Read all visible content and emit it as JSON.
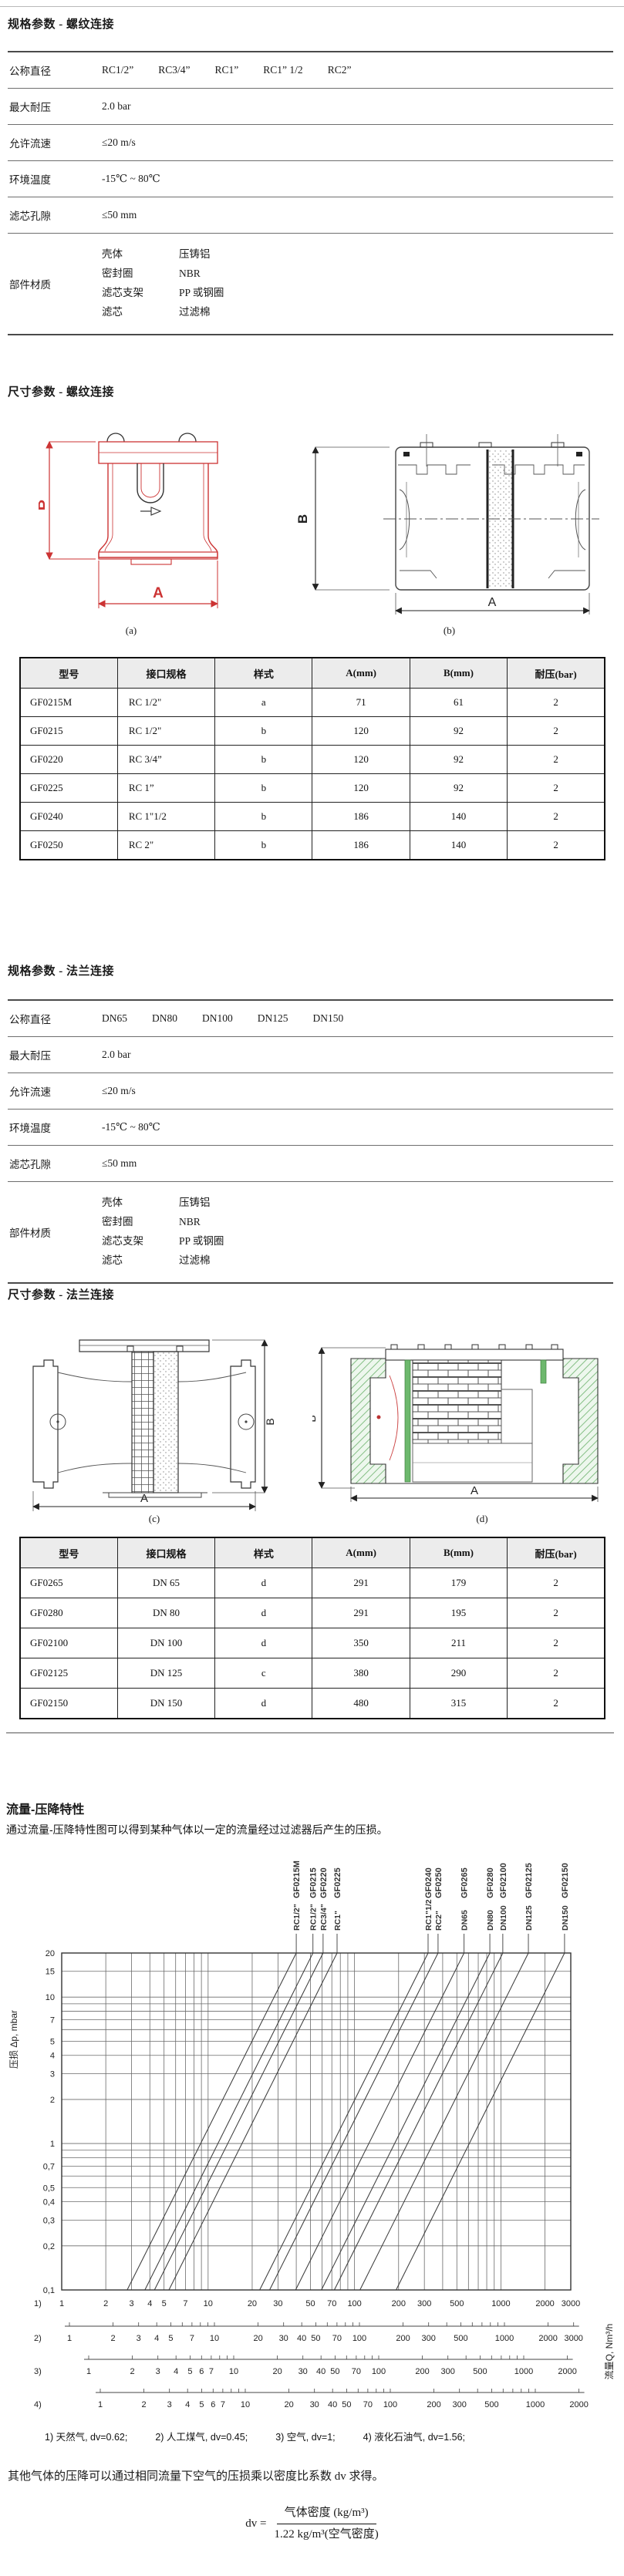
{
  "figures": {
    "dim_a": "A",
    "dim_b": "B"
  },
  "spec_thread": {
    "heading": "规格参数 - 螺纹连接",
    "rows": [
      {
        "label": "公称直径",
        "values": [
          "RC1/2”",
          "RC3/4”",
          "RC1”",
          "RC1” 1/2",
          "RC2”"
        ]
      },
      {
        "label": "最大耐压",
        "value": "2.0 bar"
      },
      {
        "label": "允许流速",
        "value": "≤20 m/s"
      },
      {
        "label": "环境温度",
        "value": "-15℃ ~ 80℃"
      },
      {
        "label": "滤芯孔隙",
        "value": "≤50 mm"
      },
      {
        "label": "部件材质",
        "pairs": [
          [
            "壳体",
            "压铸铝"
          ],
          [
            "密封圈",
            "NBR"
          ],
          [
            "滤芯支架",
            "PP 或钢圈"
          ],
          [
            "滤芯",
            "过滤棉"
          ]
        ]
      }
    ]
  },
  "dims_thread": {
    "heading": "尺寸参数 - 螺纹连接",
    "fig_a_caption": "(a)",
    "fig_b_caption": "(b)",
    "table": {
      "headers": [
        "型号",
        "接口规格",
        "样式",
        "A(mm)",
        "B(mm)",
        "耐压(bar)"
      ],
      "rows": [
        [
          "GF0215M",
          "RC 1/2\"",
          "a",
          "71",
          "61",
          "2"
        ],
        [
          "GF0215",
          "RC 1/2\"",
          "b",
          "120",
          "92",
          "2"
        ],
        [
          "GF0220",
          "RC 3/4”",
          "b",
          "120",
          "92",
          "2"
        ],
        [
          "GF0225",
          "RC 1”",
          "b",
          "120",
          "92",
          "2"
        ],
        [
          "GF0240",
          "RC 1\"1/2",
          "b",
          "186",
          "140",
          "2"
        ],
        [
          "GF0250",
          "RC 2\"",
          "b",
          "186",
          "140",
          "2"
        ]
      ]
    }
  },
  "spec_flange": {
    "heading": "规格参数 - 法兰连接",
    "rows": [
      {
        "label": "公称直径",
        "values": [
          "DN65",
          "DN80",
          "DN100",
          "DN125",
          "DN150"
        ]
      },
      {
        "label": "最大耐压",
        "value": "2.0 bar"
      },
      {
        "label": "允许流速",
        "value": "≤20 m/s"
      },
      {
        "label": "环境温度",
        "value": "-15℃ ~ 80℃"
      },
      {
        "label": "滤芯孔隙",
        "value": "≤50 mm"
      },
      {
        "label": "部件材质",
        "pairs": [
          [
            "壳体",
            "压铸铝"
          ],
          [
            "密封圈",
            "NBR"
          ],
          [
            "滤芯支架",
            "PP 或钢圈"
          ],
          [
            "滤芯",
            "过滤棉"
          ]
        ]
      }
    ]
  },
  "dims_flange": {
    "heading": "尺寸参数 - 法兰连接",
    "fig_c_caption": "(c)",
    "fig_d_caption": "(d)",
    "table": {
      "headers": [
        "型号",
        "接口规格",
        "样式",
        "A(mm)",
        "B(mm)",
        "耐压(bar)"
      ],
      "rows": [
        [
          "GF0265",
          "DN 65",
          "d",
          "291",
          "179",
          "2"
        ],
        [
          "GF0280",
          "DN 80",
          "d",
          "291",
          "195",
          "2"
        ],
        [
          "GF02100",
          "DN 100",
          "d",
          "350",
          "211",
          "2"
        ],
        [
          "GF02125",
          "DN 125",
          "c",
          "380",
          "290",
          "2"
        ],
        [
          "GF02150",
          "DN 150",
          "d",
          "480",
          "315",
          "2"
        ]
      ]
    }
  },
  "flow": {
    "heading": "流量-压降特性",
    "description": "通过流量-压降特性图可以得到某种气体以一定的流量经过过滤器后产生的压损。",
    "footnote_items": [
      "1) 天然气, dv=0.62;",
      "2) 人工煤气, dv=0.45;",
      "3) 空气, dv=1;",
      "4) 液化石油气, dv=1.56;"
    ],
    "note": "其他气体的压降可以通过相同流量下空气的压损乘以密度比系数 dv 求得。",
    "formula": {
      "lhs": "dv =",
      "numerator": "气体密度 (kg/m³)",
      "denominator": "1.22 kg/m³(空气密度)"
    }
  },
  "chart_data": {
    "type": "line",
    "title": "流量-压降特性",
    "x_axis": {
      "label": "流量Q, Nm³/h",
      "scale": "log",
      "range": [
        1,
        3000
      ]
    },
    "y_axis": {
      "label": "压损 Δp, mbar",
      "scale": "log",
      "range": [
        0.1,
        20
      ],
      "ticks": [
        [
          "20",
          20
        ],
        [
          "15",
          15
        ],
        [
          "10",
          10
        ],
        [
          "7",
          7
        ],
        [
          "5",
          5
        ],
        [
          "4",
          4
        ],
        [
          "3",
          3
        ],
        [
          "2",
          2
        ],
        [
          "1",
          1
        ],
        [
          "0,7",
          0.7
        ],
        [
          "0,5",
          0.5
        ],
        [
          "0,4",
          0.4
        ],
        [
          "0,3",
          0.3
        ],
        [
          "0,2",
          0.2
        ],
        [
          "0,1",
          0.1
        ]
      ]
    },
    "grid": "log-log, full minor decades",
    "x_scales": [
      {
        "id": "1)",
        "gas": "天然气",
        "dv": 0.62,
        "ticks": [
          "1",
          "2",
          "3",
          "4",
          "5",
          "7",
          "10",
          "20",
          "30",
          "50",
          "70",
          "100",
          "200",
          "300",
          "500",
          "1000",
          "2000",
          "3000"
        ]
      },
      {
        "id": "2)",
        "gas": "人工煤气",
        "dv": 0.45,
        "ticks": [
          "1",
          "2",
          "3",
          "4",
          "5",
          "7",
          "10",
          "20",
          "30",
          "40",
          "50",
          "70",
          "100",
          "200",
          "300",
          "500",
          "1000",
          "2000",
          "3000"
        ]
      },
      {
        "id": "3)",
        "gas": "空气",
        "dv": 1,
        "ticks": [
          "1",
          "2",
          "3",
          "4",
          "5",
          "6",
          "7",
          "10",
          "20",
          "30",
          "40",
          "50",
          "70",
          "100",
          "200",
          "300",
          "500",
          "1000",
          "2000"
        ]
      },
      {
        "id": "4)",
        "gas": "液化石油气",
        "dv": 1.56,
        "ticks": [
          "1",
          "2",
          "3",
          "4",
          "5",
          "6",
          "7",
          "10",
          "20",
          "30",
          "40",
          "50",
          "70",
          "100",
          "200",
          "300",
          "500",
          "1000",
          "2000"
        ]
      }
    ],
    "series": [
      {
        "model": "GF0215M",
        "size": "RC1/2\"",
        "q_at_20mbar": 40,
        "q_at_0_1mbar": 2.8
      },
      {
        "model": "GF0215",
        "size": "RC1/2\"",
        "q_at_20mbar": 52,
        "q_at_0_1mbar": 3.7
      },
      {
        "model": "GF0220",
        "size": "RC3/4\"",
        "q_at_20mbar": 61,
        "q_at_0_1mbar": 4.3
      },
      {
        "model": "GF0225",
        "size": "RC1\"",
        "q_at_20mbar": 76,
        "q_at_0_1mbar": 5.4
      },
      {
        "model": "GF0240",
        "size": "RC1\"1/2",
        "q_at_20mbar": 318,
        "q_at_0_1mbar": 22.5
      },
      {
        "model": "GF0250",
        "size": "RC2\"",
        "q_at_20mbar": 372,
        "q_at_0_1mbar": 26.3
      },
      {
        "model": "GF0265",
        "size": "DN65",
        "q_at_20mbar": 560,
        "q_at_0_1mbar": 39.6
      },
      {
        "model": "GF0280",
        "size": "DN80",
        "q_at_20mbar": 840,
        "q_at_0_1mbar": 59.4
      },
      {
        "model": "GF02100",
        "size": "DN100",
        "q_at_20mbar": 1030,
        "q_at_0_1mbar": 72.8
      },
      {
        "model": "GF02125",
        "size": "DN125",
        "q_at_20mbar": 1540,
        "q_at_0_1mbar": 108.9
      },
      {
        "model": "GF02150",
        "size": "DN150",
        "q_at_20mbar": 2720,
        "q_at_0_1mbar": 192.3
      }
    ]
  }
}
